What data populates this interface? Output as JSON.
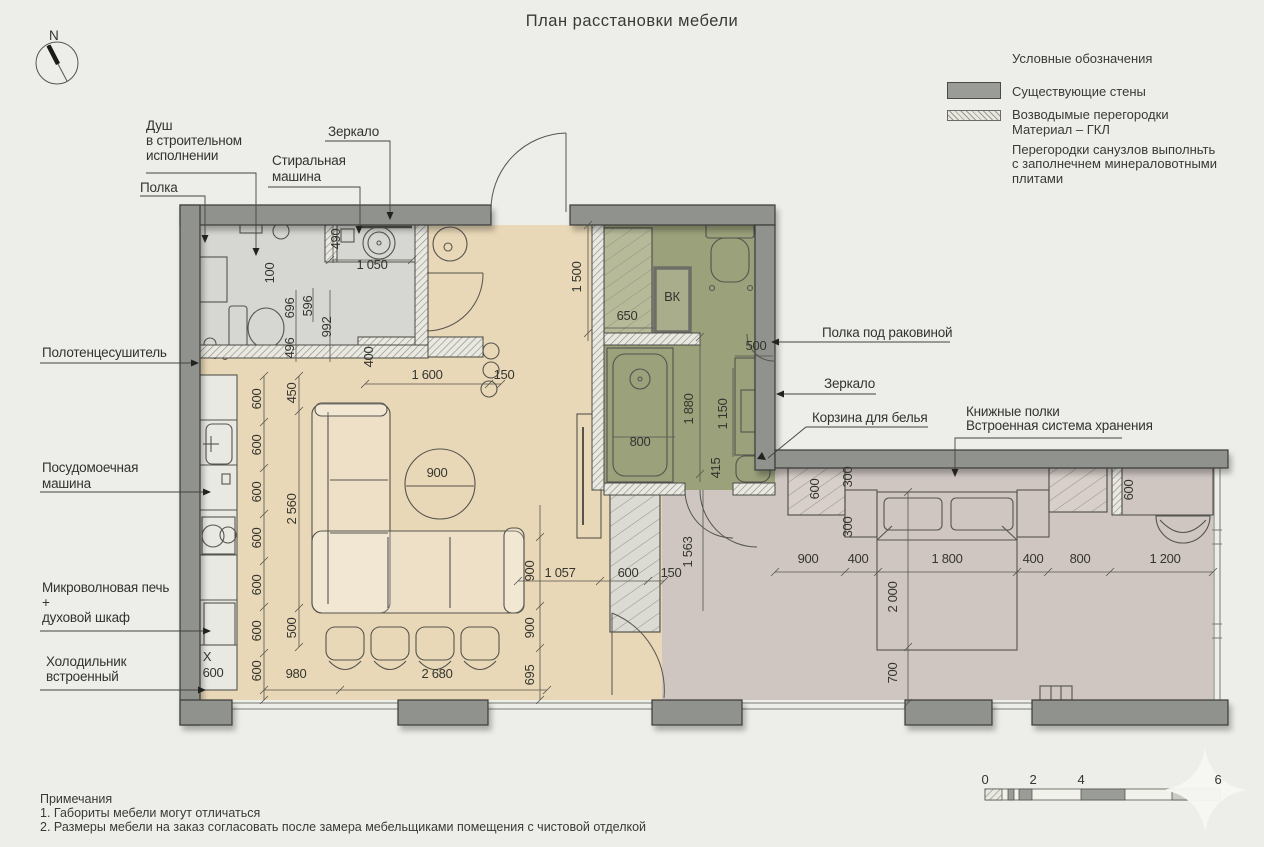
{
  "title": "План расстановки мебели",
  "compass": {
    "label": "N"
  },
  "legend": {
    "title": "Условные обозначения",
    "wall_item": "Существующие стены",
    "partition_line1": "Возводымые перегородки",
    "partition_line2": "Материал – ГКЛ",
    "note_line1": "Перегородки санузлов выполньть",
    "note_line2": "с заполнечнем минераловотными плитами"
  },
  "notes": {
    "title": "Примечания",
    "item1": "1. Габориты мебели могут отличаться",
    "item2": "2. Размеры мебели на заказ согласовать после замера мебельщиками помещения с чистовой отделкой"
  },
  "scalebar": {
    "labels": [
      {
        "text": "0",
        "x": 985
      },
      {
        "text": "2",
        "x": 1033
      },
      {
        "text": "4",
        "x": 1081
      },
      {
        "text": "6",
        "x": 1218
      }
    ]
  },
  "plan": {
    "annotations": [
      {
        "id": "shower",
        "x": 146,
        "y": 130,
        "lh": 15,
        "lines": [
          "Душ",
          "в строительном",
          "исполнении"
        ]
      },
      {
        "id": "shelf",
        "x": 140,
        "y": 192,
        "lines": [
          "Полка"
        ]
      },
      {
        "id": "washing-machine",
        "x": 272,
        "y": 165,
        "lh": 16,
        "lines": [
          "Стиральная",
          "машина"
        ]
      },
      {
        "id": "mirror-left",
        "x": 328,
        "y": 136,
        "lines": [
          "Зеркало"
        ]
      },
      {
        "id": "towel-dryer",
        "x": 42,
        "y": 357,
        "lines": [
          "Полотенцесушитель"
        ]
      },
      {
        "id": "dishwasher",
        "x": 42,
        "y": 472,
        "lh": 16,
        "lines": [
          "Посудомоечная",
          "машина"
        ]
      },
      {
        "id": "microwave-oven",
        "x": 42,
        "y": 592,
        "lh": 15,
        "lines": [
          "Микроволновая печь",
          "+",
          "духовой шкаф"
        ]
      },
      {
        "id": "fridge",
        "x": 46,
        "y": 666,
        "lh": 15,
        "lines": [
          "Холодильник",
          "встроенный"
        ]
      },
      {
        "id": "shelf-under-sink",
        "x": 822,
        "y": 337,
        "lines": [
          "Полка под раковиной"
        ]
      },
      {
        "id": "mirror-right",
        "x": 824,
        "y": 388,
        "lines": [
          "Зеркало"
        ]
      },
      {
        "id": "laundry-basket",
        "x": 812,
        "y": 422,
        "lines": [
          "Корзина для белья"
        ]
      },
      {
        "id": "bookshelves",
        "x": 966,
        "y": 416,
        "lh": 14,
        "lines": [
          "Книжные полки",
          "Встроенная система хранения"
        ]
      },
      {
        "id": "compass-n",
        "x": 49,
        "y": 40,
        "lines": [
          "N"
        ]
      }
    ],
    "dimensions": [
      {
        "t": "600",
        "x": 261,
        "y": 399,
        "r": 1
      },
      {
        "t": "600",
        "x": 261,
        "y": 445,
        "r": 1
      },
      {
        "t": "600",
        "x": 261,
        "y": 492,
        "r": 1
      },
      {
        "t": "600",
        "x": 261,
        "y": 538,
        "r": 1
      },
      {
        "t": "600",
        "x": 261,
        "y": 585,
        "r": 1
      },
      {
        "t": "600",
        "x": 261,
        "y": 631,
        "r": 1
      },
      {
        "t": "600",
        "x": 261,
        "y": 671,
        "r": 1
      },
      {
        "t": "450",
        "x": 296,
        "y": 393,
        "r": 1
      },
      {
        "t": "2 560",
        "x": 296,
        "y": 509,
        "r": 1
      },
      {
        "t": "500",
        "x": 296,
        "y": 628,
        "r": 1
      },
      {
        "t": "X",
        "x": 207,
        "y": 661
      },
      {
        "t": "600",
        "x": 213,
        "y": 677
      },
      {
        "t": "980",
        "x": 296,
        "y": 678
      },
      {
        "t": "2 680",
        "x": 437,
        "y": 678
      },
      {
        "t": "100",
        "x": 274,
        "y": 273,
        "r": 1
      },
      {
        "t": "490",
        "x": 340,
        "y": 239,
        "r": 1
      },
      {
        "t": "1 050",
        "x": 372,
        "y": 269
      },
      {
        "t": "696",
        "x": 294,
        "y": 308,
        "r": 1
      },
      {
        "t": "596",
        "x": 312,
        "y": 306,
        "r": 1
      },
      {
        "t": "992",
        "x": 331,
        "y": 327,
        "r": 1
      },
      {
        "t": "496",
        "x": 294,
        "y": 348,
        "r": 1
      },
      {
        "t": "400",
        "x": 373,
        "y": 357,
        "r": 1
      },
      {
        "t": "1 600",
        "x": 427,
        "y": 379
      },
      {
        "t": "150",
        "x": 504,
        "y": 379
      },
      {
        "t": "900",
        "x": 437,
        "y": 477
      },
      {
        "t": "1 057",
        "x": 560,
        "y": 577
      },
      {
        "t": "600",
        "x": 628,
        "y": 577
      },
      {
        "t": "150",
        "x": 671,
        "y": 577
      },
      {
        "t": "900",
        "x": 534,
        "y": 571,
        "r": 1
      },
      {
        "t": "900",
        "x": 534,
        "y": 628,
        "r": 1
      },
      {
        "t": "695",
        "x": 534,
        "y": 675,
        "r": 1
      },
      {
        "t": "1 500",
        "x": 581,
        "y": 277,
        "r": 1
      },
      {
        "t": "650",
        "x": 627,
        "y": 320
      },
      {
        "t": "ВК",
        "x": 672,
        "y": 301
      },
      {
        "t": "500",
        "x": 756,
        "y": 350
      },
      {
        "t": "1 880",
        "x": 693,
        "y": 409,
        "r": 1
      },
      {
        "t": "1 150",
        "x": 727,
        "y": 414,
        "r": 1
      },
      {
        "t": "415",
        "x": 720,
        "y": 468,
        "r": 1
      },
      {
        "t": "800",
        "x": 640,
        "y": 446
      },
      {
        "t": "1 563",
        "x": 692,
        "y": 552,
        "r": 1
      },
      {
        "t": "600",
        "x": 819,
        "y": 489,
        "r": 1
      },
      {
        "t": "300",
        "x": 852,
        "y": 477,
        "r": 1
      },
      {
        "t": "300",
        "x": 852,
        "y": 527,
        "r": 1
      },
      {
        "t": "600",
        "x": 1133,
        "y": 490,
        "r": 1
      },
      {
        "t": "900",
        "x": 808,
        "y": 563
      },
      {
        "t": "400",
        "x": 858,
        "y": 563
      },
      {
        "t": "1 800",
        "x": 947,
        "y": 563
      },
      {
        "t": "400",
        "x": 1033,
        "y": 563
      },
      {
        "t": "800",
        "x": 1080,
        "y": 563
      },
      {
        "t": "1 200",
        "x": 1165,
        "y": 563
      },
      {
        "t": "2 000",
        "x": 897,
        "y": 597,
        "r": 1
      },
      {
        "t": "700",
        "x": 897,
        "y": 673,
        "r": 1
      }
    ]
  },
  "colors": {
    "background": "#edeee9",
    "existing_wall": "#90928e",
    "living_floor": "#e9d8b7",
    "bathroom_floor": "#9ba17b",
    "bedroom_floor": "#cfc6c2",
    "wet_floor": "#d6d6d2"
  }
}
